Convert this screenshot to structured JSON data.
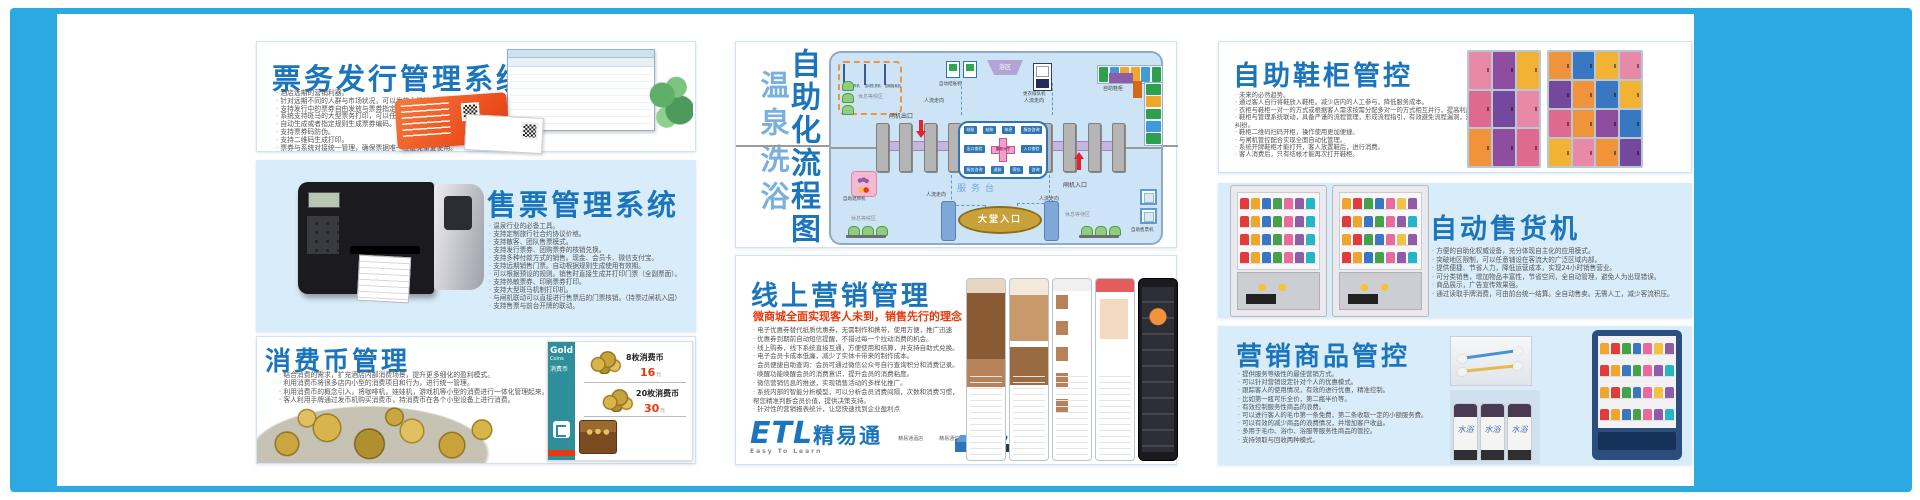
{
  "palette": {
    "frame_blue": "#2baae2",
    "panel_blue": "#d9ecf9",
    "title_blue": "#1b75bc",
    "accent_red": "#e8380d",
    "diagram_bg": "#cde4f6"
  },
  "panels": {
    "ticket_issue": {
      "title": "票务发行管理系统",
      "bullets": [
        "酒店远期的营销利器。",
        "针对远期不同的人群与市场状况，可以发放大量的远期票务。",
        "支持发行中的票券自由发放与票券指定售卖收款。",
        "系统支持斑马的大型票务打印，可以任意设计票券打印样式。",
        "自动生成或者指定规则生成票券编码。",
        "支持票券码防伪。",
        "支持二维码生成打印。",
        "票券与系统对接统一管理，确保票据唯一性避免重复使用。"
      ]
    },
    "ticket_sale": {
      "title": "售票管理系统",
      "bullets": [
        "温泉行业的必备工具。",
        "支持定制旅行社合约协议价格。",
        "支持散客、团队售票模式。",
        "支持发行票券、团购票券的核销兑换。",
        "支持多种付款方式的销售。现金、会员卡、微信支付宝。",
        "支持远期销售门票。自动根据规则生成使用有效期。",
        "可以根据预设的规则。销售时直接生成并打印门票（全副票面）。",
        "支持热敏票券、印刷票券打印。",
        "支持大型斑马机制打印机。",
        "与闸机联动可以直接进行售票后的门票核销。（持票过闸机入园）",
        "支持售票与前台开牌的联动。"
      ]
    },
    "coin": {
      "title": "消费币管理",
      "bullets": [
        "结合消费的需求，扩充酒店内部消费场景，提升更多细化的盈利模式。",
        "利用消费币将很多店内小型的消费项目和行为，进行统一管理。",
        "利用消费币的概念引入，将咖啡机，娃娃机，游戏机等小型的消费进行一体化管理起来。",
        "客人利用手牌通过发币机购买消费币，持消费币在各个小型设备上进行消费。"
      ],
      "card": {
        "brand": "Gold",
        "brand_sub": "Coins",
        "brand_cn": "消费币",
        "items": [
          {
            "name": "8枚消费币",
            "price": "16",
            "unit": "元"
          },
          {
            "name": "20枚消费币",
            "price": "30",
            "unit": "元"
          }
        ]
      }
    },
    "flow": {
      "title": "自助化流程图",
      "subtitle": "温泉洗浴",
      "zone_machines": [
        "自助售币机",
        "自动售货机",
        "自助贩卖机"
      ],
      "labels": {
        "rest_tl": "休息等候区",
        "auto_checkout": "自动结账机",
        "bath": "浴区",
        "queue": "更衣排队机",
        "shoe": "自助鞋柜",
        "gate_exit": "闸机出口",
        "gate_entry": "闸机入口",
        "service_desk": "服务台",
        "flow_dir": "人流走向",
        "lobby": "大堂入口",
        "rest_bl": "休息等候区",
        "rest_br": "休息等待区",
        "ticket_br": "自助售票机",
        "return_bl": "自助退牌机"
      },
      "service_box": {
        "top": [
          "结账",
          "结账",
          "休息",
          "服务咨询"
        ],
        "left": "出口查验",
        "right": "入口查验",
        "bottom": [
          "服务咨询",
          "退账",
          "寄存",
          "咨询"
        ],
        "center": "服务大厅"
      }
    },
    "marketing": {
      "title": "线上营销管理",
      "subtitle": "微商城全面实现客人未到，销售先行的理念",
      "bullets": [
        "电子优惠券替代纸质优惠券，无需制作和携带，使用方便，推广迅速",
        "优惠券到期前自动短信提醒，不错过每一个拉动消费的机会。",
        "线上购券，线下系统直接互通，方便使用和结算，并支持自助式兑换。",
        "电子会员卡成本低廉，减少了实体卡带来的制作成本。",
        "会员便捷自助查询：会员可通过微信公众号自行查询积分和消费记录。",
        "唤醒功能唤醒会员的消费意识，提升会员的消费粘度。",
        "微信营销信息的推送，实现销售活动的多样化推广。",
        "系统内部的智能分析模型，可以分析会员消费间隔，次数和消费习惯，帮您精准判断会员价值，提供决策支持。",
        "针对性的营销报表统计，让您快速找到企业盈利点"
      ],
      "logo": {
        "brand": "ETL",
        "brand_cn": "精易通",
        "tagline": "Easy To Learn"
      },
      "logo_items": [
        "精易通酒店",
        "精易通信息",
        "精易通智能"
      ]
    },
    "shoe": {
      "title": "自助鞋柜管控",
      "bullets": [
        "未来的必然趋势。",
        "通过客人自行将鞋放入鞋柜。减少店内的人工参与，降低服务成本。",
        "衣柜与鞋柜一对一的方式或根据客人需求按需分配多对一的方式相互并行，提高利用率。",
        "鞋柜与管理系统联动，具备严谨的流程管理，形成流程指引，有效避免流程漏洞，避免出现拿错鞋引起的纠纷。",
        "鞋柜二维码扫码开柜，操作使用更加便捷。",
        "与闸机管控配合实现全面自动化管理。",
        "系统开牌鞋柜才能打开，客人放置鞋后，进行消费。",
        "客人消费后，只有结帐才能再次打开鞋柜。"
      ]
    },
    "vending": {
      "title": "自动售货机",
      "bullets": [
        "方便的自助化权威设备，充分体现自主化的应用模式。",
        "突破地区限制，可以任意铺设在客流大的广泛区域内部。",
        "提供便捷、节省人力，降低运营成本，实现24小时销售营业。",
        "可分类销售，增加物品丰富性，节省空间，全自动管理，避免人为出现错误。",
        "商品展示，广告宣传效果强。",
        "通过读取手牌消费，可由前台统一结算。全自动售卖。无需人工，减少客流积压。"
      ]
    },
    "goods": {
      "title": "营销商品管控",
      "bullets": [
        "提供服务等级性的最佳营销方式。",
        "可以针对营销设定针对个人的优惠模式。",
        "跟踪客人的使用情况，有效的进行优惠，精准控制。",
        "比如第一瓶可乐全价，第二瓶半价等。",
        "有效控制服务性商品的浪费。",
        "可以进行客人的毛巾第一条免费，第二条收取一定的小额服务费。",
        "可以有效的减少商品的浪费情况，并增加客户收益。",
        "多用于毛巾、浴巾、浴服等服务性商品的管控。",
        "支持领取与回收两种模式。"
      ],
      "bottle_label": "水浴"
    }
  },
  "decor": {
    "products": [
      "#e23b3b",
      "#f0a62a",
      "#3a77c2",
      "#46a14b",
      "#e86a9e",
      "#8e5ca8",
      "#25b5c4"
    ],
    "snacks": [
      "#f0a62a",
      "#e23b3b",
      "#46a14b",
      "#3a77c2",
      "#e86a9e",
      "#f3c242",
      "#8e5ca8"
    ],
    "locker_pink": [
      "#e989a8",
      "#8e4d9e",
      "#f2b234",
      "#e06a8f",
      "#74489d",
      "#e989a8",
      "#f0933a",
      "#8e4d9e",
      "#e06a8f"
    ],
    "locker_mix": [
      "#f0933a",
      "#3a77c2",
      "#f2b234",
      "#e989a8",
      "#74489d",
      "#f0933a",
      "#3a77c2",
      "#f2b234",
      "#e06a8f",
      "#f0933a",
      "#8e4d9e",
      "#3a77c2",
      "#f2b234",
      "#e989a8",
      "#f0933a",
      "#74489d"
    ],
    "shoe_row": [
      "#2e9e4f",
      "#3f9bd8",
      "#f0a62a",
      "#f0a62a",
      "#3f9bd8",
      "#2e9e4f"
    ],
    "shoe_col": [
      "#2e9e4f",
      "#f0a62a",
      "#2e9e4f",
      "#3f9bd8",
      "#2e9e4f"
    ]
  }
}
